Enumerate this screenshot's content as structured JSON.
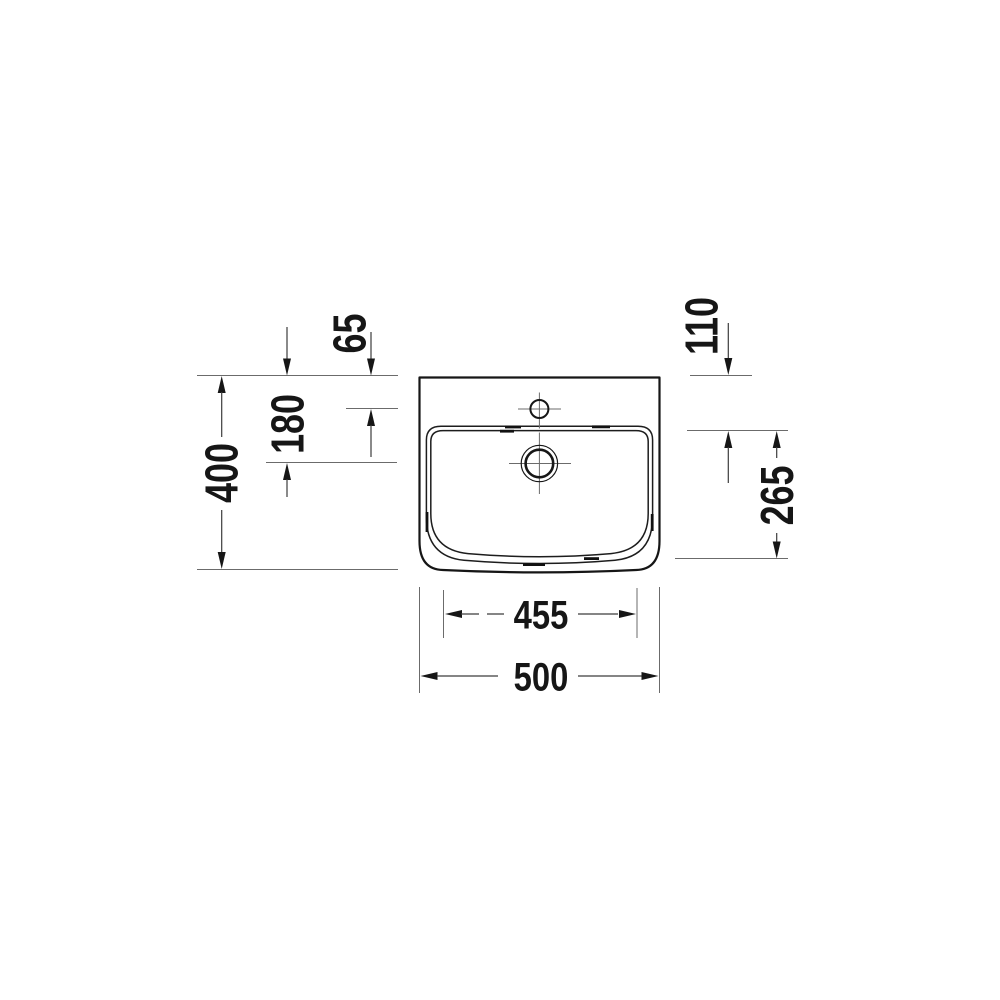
{
  "page": {
    "background": "#ffffff"
  },
  "drawing": {
    "type": "technical-dimension-drawing",
    "subject": "washbasin top view",
    "unit_system": "mm",
    "line_color": "#161616",
    "labels": {
      "tap_hole_offset": "65",
      "rim_offset": "110",
      "drain_offset": "180",
      "overall_depth": "400",
      "bowl_depth": "265",
      "bowl_width": "455",
      "overall_width": "500"
    }
  }
}
